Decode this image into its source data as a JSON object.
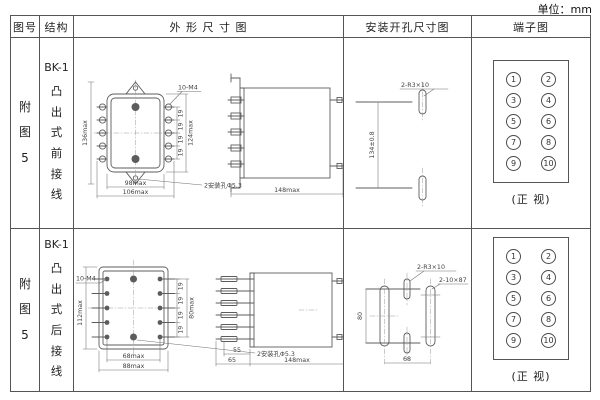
{
  "unit_label": "单位：mm",
  "headers": {
    "fig_no": "图号",
    "structure": "结构",
    "outline": "外 形 尺 寸 图",
    "install": "安装开孔尺寸图",
    "terminal": "端子图"
  },
  "rows": [
    {
      "fig_no": "附图5",
      "structure_model": "BK-1",
      "structure_type": "凸出式前接线",
      "outline": {
        "dim_height_outer": "136max",
        "dim_height_inner": "124max",
        "screw_label": "10-M4",
        "pitch": "19",
        "dim_width_inner": "98max",
        "dim_width_outer": "106max",
        "hole_label": "2安装孔Φ5.3",
        "dim_depth": "148max"
      },
      "install": {
        "slot_label": "2-R3×10",
        "dim_vertical": "134±0.8"
      },
      "terminal": {
        "left": [
          "1",
          "3",
          "5",
          "7",
          "9"
        ],
        "right": [
          "2",
          "4",
          "6",
          "8",
          "10"
        ],
        "caption": "(正 视)"
      }
    },
    {
      "fig_no": "附图5",
      "structure_model": "BK-1",
      "structure_type": "凸出式后接线",
      "outline": {
        "screw_label": "10-M4",
        "dim_height_outer": "112max",
        "pitch": "19",
        "dim_height_inner": "80max",
        "dim_width_inner": "68max",
        "dim_width_outer": "88max",
        "hole_label": "2安装孔Φ5.3",
        "dim_stud_inner": "55",
        "dim_stud_outer": "65",
        "dim_depth": "148max"
      },
      "install": {
        "slot_label_small": "2-R3×10",
        "slot_label_big": "2-10×87",
        "dim_vertical": "80",
        "dim_horizontal": "68"
      },
      "terminal": {
        "left": [
          "1",
          "3",
          "5",
          "7",
          "9"
        ],
        "right": [
          "2",
          "4",
          "6",
          "8",
          "10"
        ],
        "caption": "(正 视)"
      }
    }
  ]
}
